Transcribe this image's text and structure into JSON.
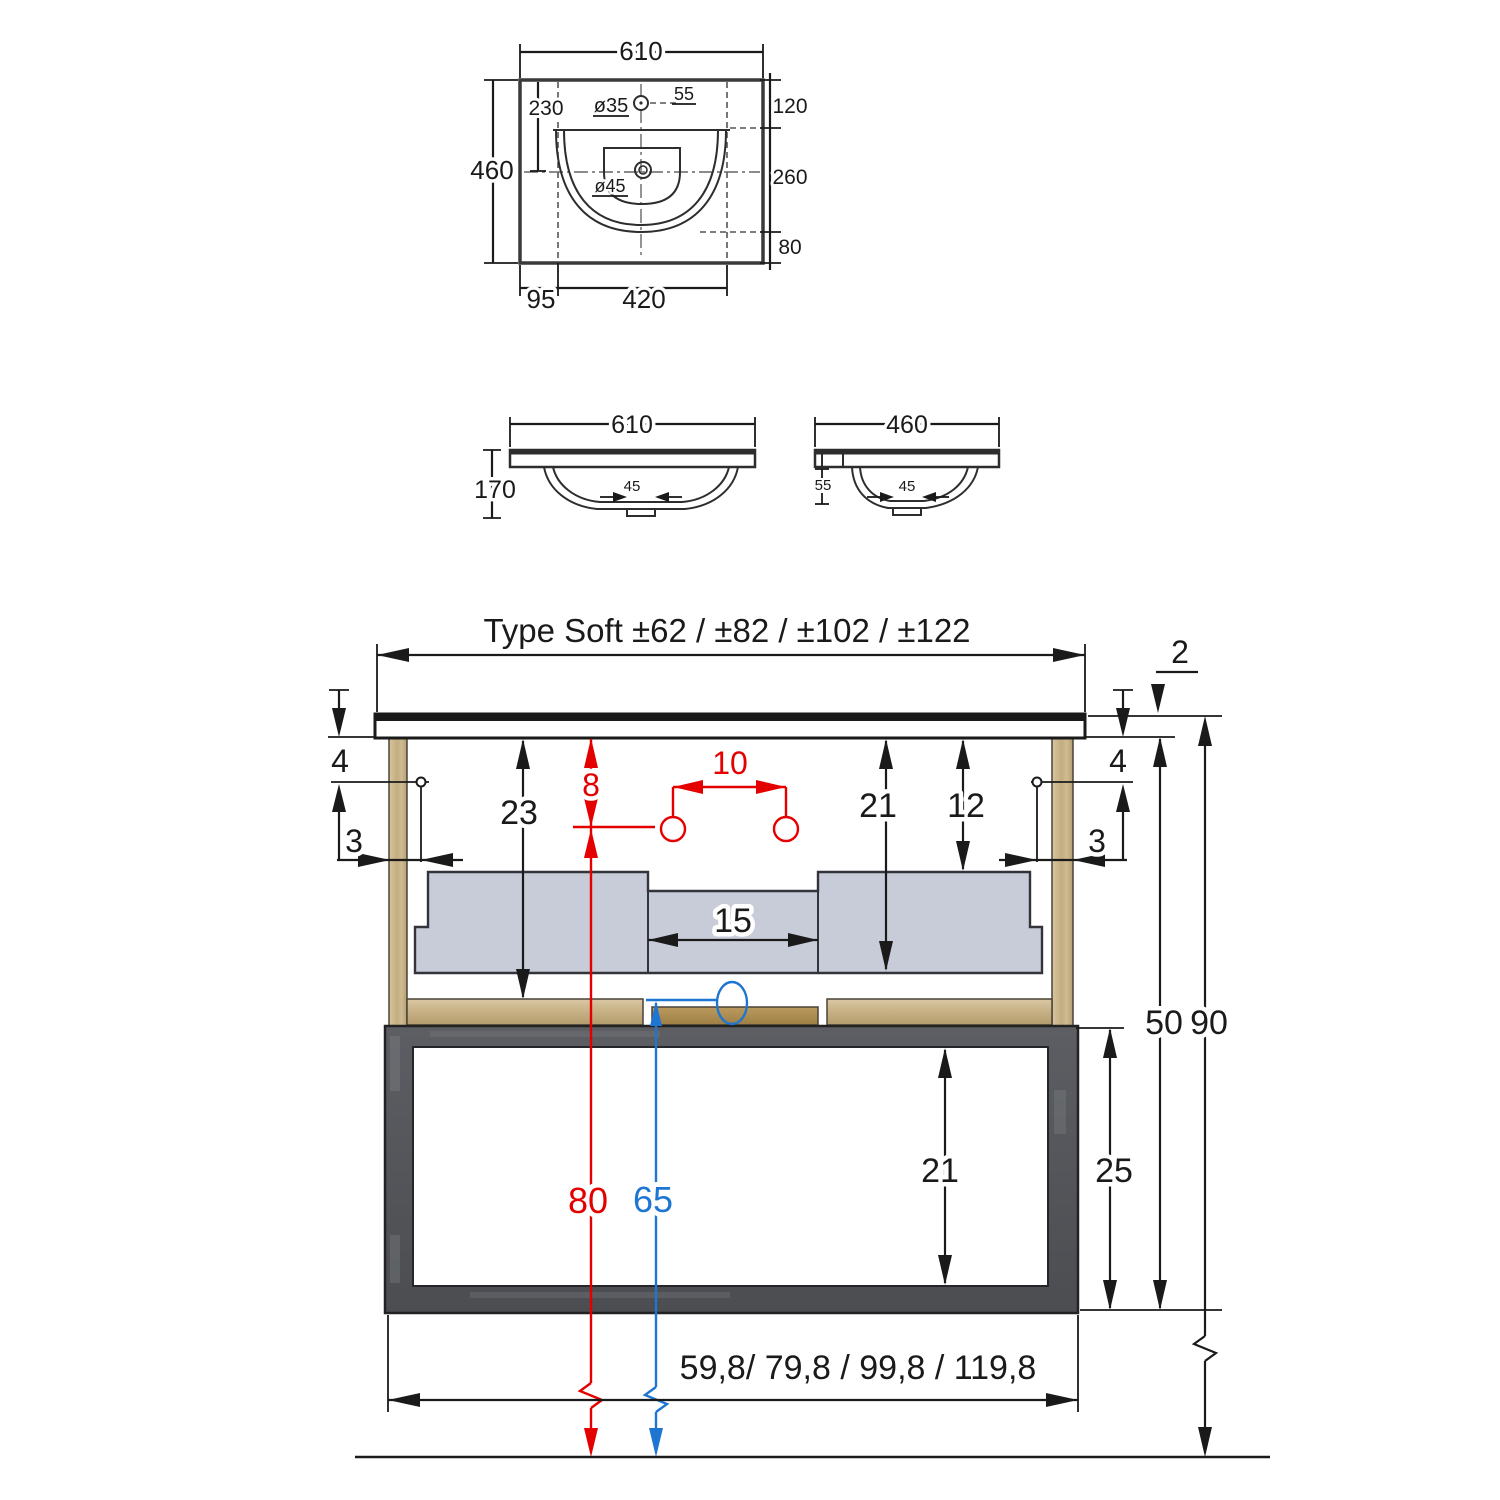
{
  "colors": {
    "dimension_black": "#1a1a1a",
    "accent_red": "#e50000",
    "accent_blue": "#1f76d2",
    "wood_tan": "#cdb88b",
    "shelf_center_brown": "#ae8f51",
    "basin_gray": "#c8ccd9",
    "frame_dark_gray": "#54565a"
  },
  "top_view": {
    "width": "610",
    "depth": "460",
    "tap_centre_offset": "230",
    "tap_hole_diameter": "ø35",
    "tap_side_offset": "55",
    "front_edge_to_basin": "120",
    "basin_length": "260",
    "basin_to_back_edge": "80",
    "side_margin": "95",
    "basin_width": "420",
    "drain_diameter": "ø45"
  },
  "front_view": {
    "width": "610",
    "height": "170",
    "drain_width": "45"
  },
  "side_view": {
    "depth": "460",
    "edge_detail": "55",
    "drain_width": "45"
  },
  "main_view": {
    "title": "Type Soft ±62 / ±82 / ±102 / ±122",
    "countertop_thickness": "2",
    "screw_down_left": "4",
    "screw_in_left": "3",
    "screw_down_right": "4",
    "screw_in_right": "3",
    "top_to_shelf": "23",
    "fixing_drop": "8",
    "fixing_spacing": "10",
    "basin_body_height": "21",
    "basin_clearance": "12",
    "recess_width": "15",
    "cabinet_height": "50",
    "total_height": "90",
    "red_outlet_height": "80",
    "blue_outlet_height": "65",
    "drawer_inner_height": "21",
    "drawer_box_height": "25",
    "cabinet_widths": "59,8/ 79,8 / 99,8 / 119,8"
  }
}
